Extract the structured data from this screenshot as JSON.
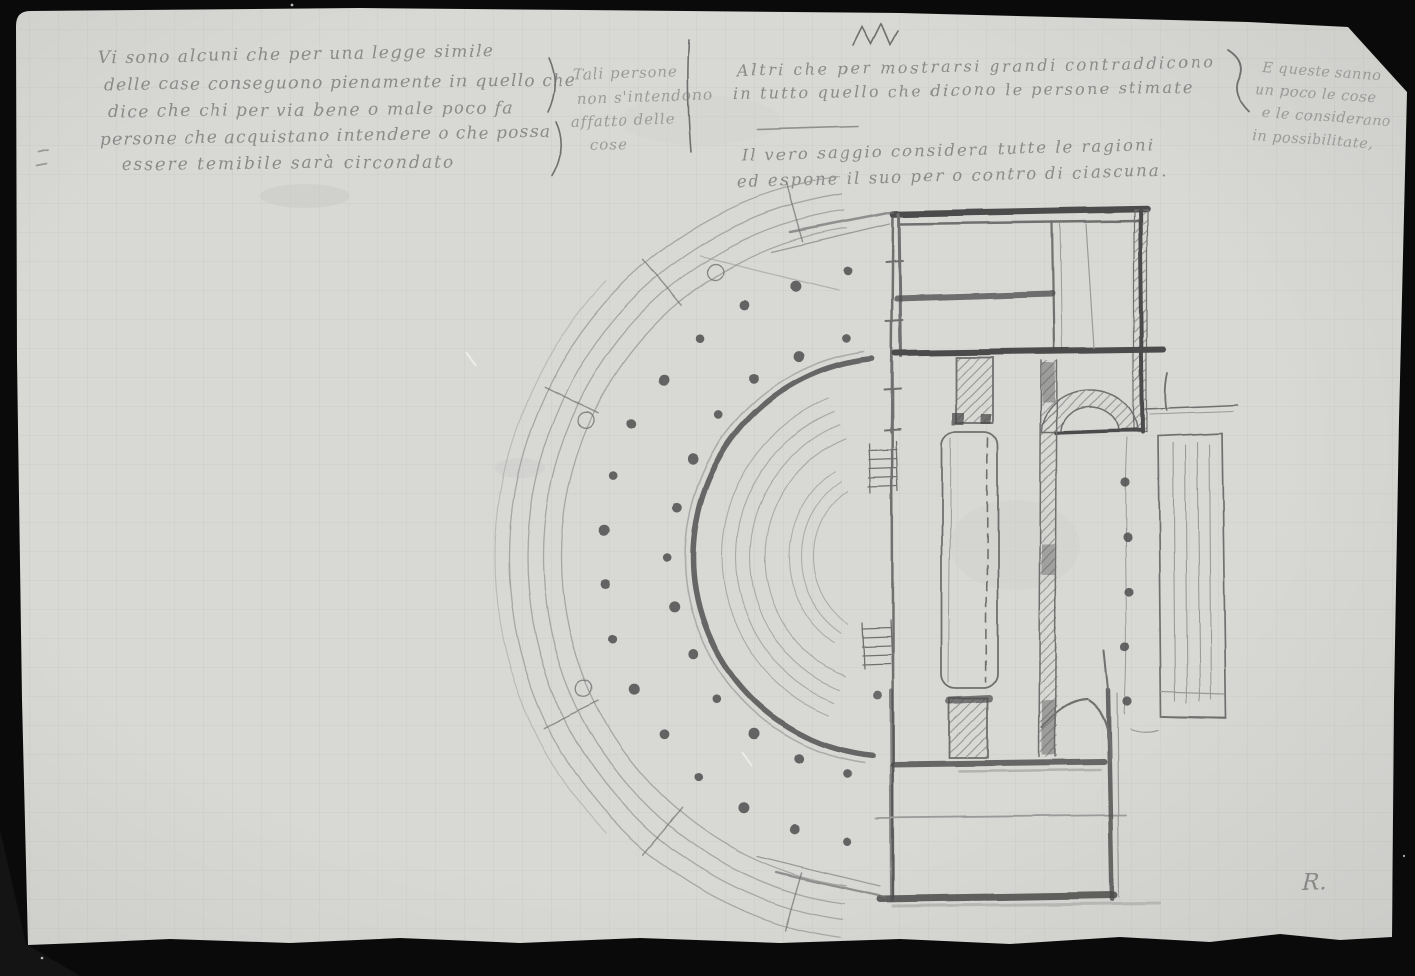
{
  "photo": {
    "backdrop_color": "#0a0a0a",
    "paper_color": "#d8d8d5",
    "grid_color": "#bcc1ba",
    "ink_color": "#7f7f7f",
    "ink_light_color": "#929292",
    "pencil_light": "#9a9a9a",
    "pencil_mid": "#6f6f6f",
    "pencil_dark": "#4b4b4b",
    "dot_color": "#4f4f4f"
  },
  "notes": {
    "block1": [
      "Vi sono alcuni che per una legge simile",
      "delle case conseguono pienamente in quello che",
      "dice che chi per via bene o male poco fa",
      "persone che acquistano intendere o che possa",
      "essere temibile sarà circondato"
    ],
    "block2": [
      "Tali persone",
      "non s'intendono",
      "affatto delle",
      "cose"
    ],
    "block3": [
      "Altri che per mostrarsi grandi contraddicono",
      "in tutto quello che dicono le persone stimate"
    ],
    "block4": [
      "E queste sanno",
      "un poco le cose",
      "e le considerano",
      "in possibilitate,"
    ],
    "block5": [
      "Il vero saggio considera tutte le ragioni",
      "ed espone il suo per o contro di ciascuna."
    ],
    "signature": "R."
  },
  "sketch": {
    "center": {
      "x": 893,
      "y": 557
    },
    "rings": {
      "portico_radii": [
        332,
        350,
        366,
        384
      ],
      "portico_angle_range": [
        98,
        262
      ],
      "outer_faint": {
        "radius": 398,
        "range": [
          136,
          224
        ]
      },
      "heavy_wall": {
        "radius": 200,
        "range": [
          96,
          264
        ]
      },
      "heavy_echo_radius": 208,
      "seat_radii": [
        128,
        143,
        157,
        171
      ],
      "seat_angle_range": [
        112,
        248
      ],
      "orchestra_radii": [
        80,
        92,
        104
      ],
      "orchestra_angle_range": [
        124,
        236
      ],
      "outer_dots": {
        "radius": 291,
        "count": 16,
        "start_angle": 99,
        "end_angle": 261
      },
      "inner_dots": {
        "radius": 224,
        "count": 13,
        "start_angle": 102,
        "end_angle": 258
      }
    },
    "radial_tick_angles": [
      106,
      130,
      154,
      206,
      230,
      254
    ],
    "small_circle_angles": [
      157,
      204,
      238
    ],
    "small_circle_ring_radius": 336,
    "right_colonnade_dots": {
      "x": 1127,
      "y_values": [
        482,
        537,
        592,
        647,
        701
      ]
    },
    "extra_dots": [
      [
        877,
        694
      ]
    ]
  }
}
